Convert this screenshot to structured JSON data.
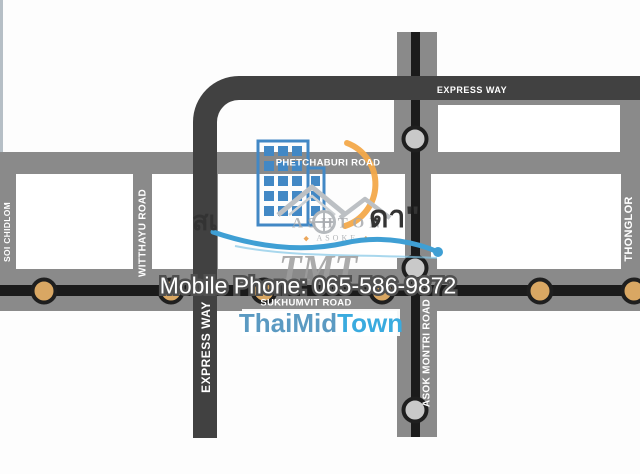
{
  "map": {
    "labels": {
      "express_way_h": "EXPRESS WAY",
      "express_way_v": "EXPRESS WAY",
      "phetchaburi": "PHETCHABURI ROAD",
      "sukhumvit": "SUKHUMVIT ROAD",
      "asok_montri": "ASOK MONTRI ROAD",
      "thonglor": "THONGLOR",
      "witthayu": "WITTHAYU ROAD",
      "soi_chidlom": "SOI CHIDLOM"
    },
    "colors": {
      "road_gray": "#8a8a8a",
      "express_dark": "#414141",
      "transit_line": "#1b1b1b",
      "bts_station_fill": "#d9a763",
      "mrt_station_fill": "#c9c9c9",
      "station_ring": "#1f1f1f"
    },
    "stations": {
      "bts_x": [
        44,
        171,
        264,
        382,
        540,
        634
      ],
      "bts_y": 291,
      "mrt_x": 415,
      "mrt_y": [
        139,
        268,
        410
      ]
    }
  },
  "watermark": {
    "thai_fragment_left": "สเ",
    "thai_fragment_right": "ดา\"",
    "logo_line1": "ASHTON",
    "logo_line2": "ASOKE",
    "tmt": "TMT",
    "phone": "Mobile Phone: 065-586-9872",
    "site_thaimid": "ThaiMid",
    "site_town": "Town",
    "building_color": "#4288c5",
    "arc_color": "#f3a94a",
    "wave_color": "#3f9fd4"
  }
}
